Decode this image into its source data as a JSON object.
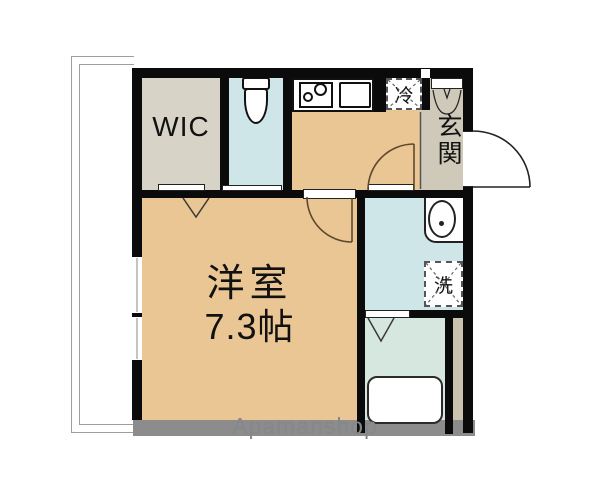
{
  "floorplan": {
    "title": "apartment-floor-plan",
    "rooms": {
      "wic": {
        "label": "WIC"
      },
      "main_room": {
        "label": "洋室",
        "size": "7.3帖"
      },
      "genkan": {
        "label": "玄関"
      },
      "refrigerator_space": {
        "label": "冷"
      },
      "laundry_space": {
        "label": "洗"
      }
    },
    "watermark": "Apamanshop",
    "icons": [
      "balcony",
      "window-icon",
      "toilet-icon",
      "stove-icon",
      "kitchen-sink-icon",
      "refrigerator-space-icon",
      "shoe-cabinet-icon",
      "entrance-door-arc-icon",
      "room-door-arc-icon",
      "washroom-door-arc-icon",
      "folding-door-icon",
      "washbasin-icon",
      "washing-machine-space-icon",
      "bathtub-icon",
      "pipe-space"
    ],
    "colors": {
      "floor_tan": "#e9c693",
      "wic_grey": "#d7d3c6",
      "water_blue": "#cee6e7",
      "bath_green": "#d5e7df",
      "genkan_grey": "#cfc9b9",
      "pipe_beige": "#cac3ae",
      "wall_black": "#0b0b0b",
      "bottom_wall_grey": "#8c8c8c",
      "door_arc_brown": "#5f482c"
    }
  }
}
